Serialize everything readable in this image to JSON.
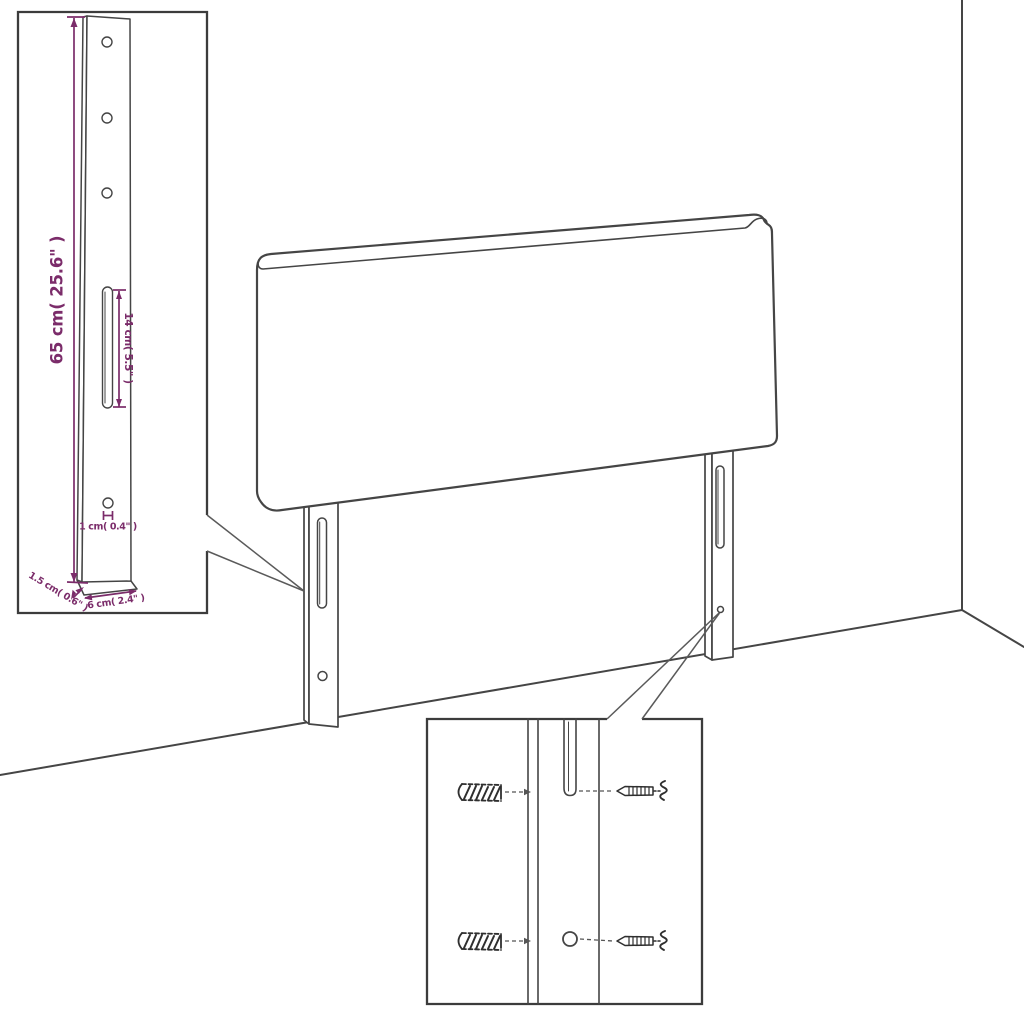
{
  "colors": {
    "line": "#454545",
    "dimension": "#7b2c6a",
    "hardware": "#2f2f2f",
    "background": "#ffffff"
  },
  "dimensions": {
    "total_height": "65 cm( 25.6\" )",
    "slot_length": "14 cm( 5.5\" )",
    "hole_offset": "1 cm( 0.4\" )",
    "leg_width": "6 cm( 2.4\" )",
    "leg_thickness": "1.5 cm( 0.6\" )"
  }
}
